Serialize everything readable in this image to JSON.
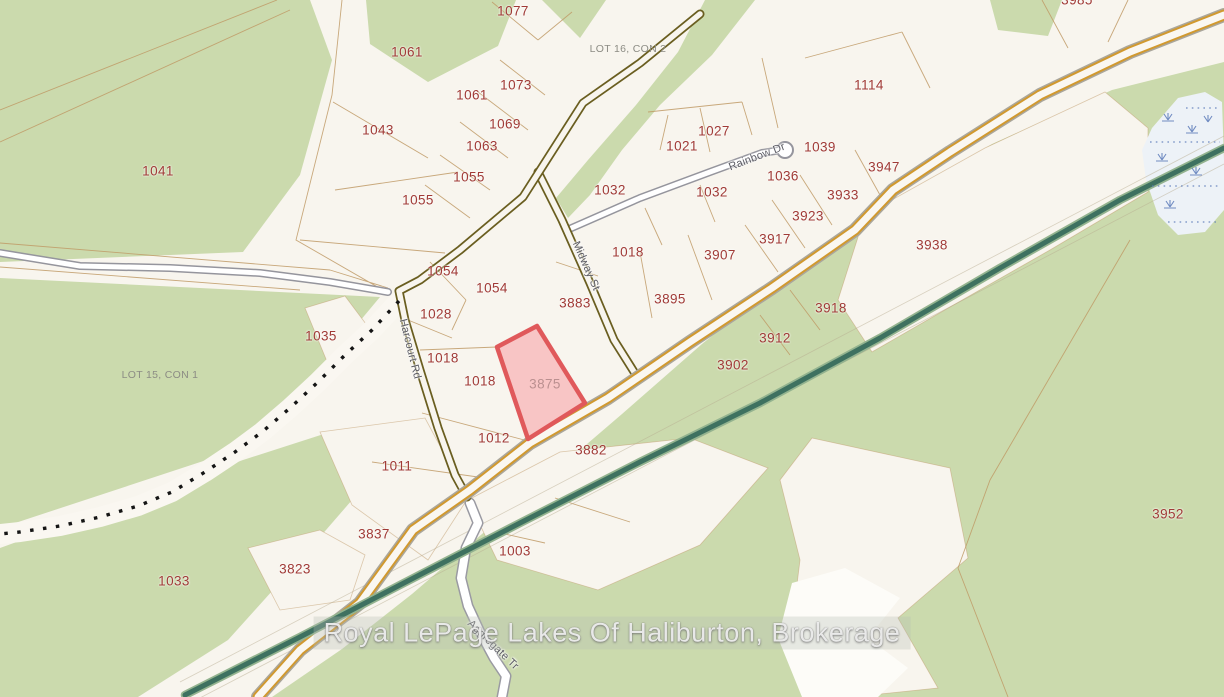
{
  "map": {
    "watermark": {
      "text": "Royal LePage Lakes Of Haliburton, Brokerage"
    },
    "highlighted_parcel": {
      "id": "3875",
      "fill": "#f8c5c5",
      "border": "#e0595b"
    },
    "colors": {
      "background_cream": "#f8f5ee",
      "vegetation_green": "#cbdaad",
      "main_road_orange": "#d1992f",
      "local_road_olive": "#6a5e20",
      "minor_road_gray": "#95959d",
      "rail_trail_green": "#3e7160",
      "parcel_line_tan": "#c09a66",
      "parcel_number_red": "#a03a36",
      "wetland_blue": "#edf2f7"
    },
    "parcel_labels": [
      {
        "text": "1077",
        "x": 513,
        "y": 11
      },
      {
        "text": "1061",
        "x": 407,
        "y": 52
      },
      {
        "text": "1061",
        "x": 472,
        "y": 95
      },
      {
        "text": "1073",
        "x": 516,
        "y": 85
      },
      {
        "text": "1069",
        "x": 505,
        "y": 124
      },
      {
        "text": "1063",
        "x": 482,
        "y": 146
      },
      {
        "text": "1043",
        "x": 378,
        "y": 130
      },
      {
        "text": "1055",
        "x": 469,
        "y": 177
      },
      {
        "text": "1055",
        "x": 418,
        "y": 200
      },
      {
        "text": "1041",
        "x": 158,
        "y": 171
      },
      {
        "text": "1114",
        "x": 869,
        "y": 85
      },
      {
        "text": "1027",
        "x": 714,
        "y": 131
      },
      {
        "text": "1021",
        "x": 682,
        "y": 146
      },
      {
        "text": "1039",
        "x": 820,
        "y": 147
      },
      {
        "text": "1036",
        "x": 783,
        "y": 176
      },
      {
        "text": "3947",
        "x": 884,
        "y": 167
      },
      {
        "text": "1032",
        "x": 610,
        "y": 190
      },
      {
        "text": "1032",
        "x": 712,
        "y": 192
      },
      {
        "text": "3933",
        "x": 843,
        "y": 195
      },
      {
        "text": "3923",
        "x": 808,
        "y": 216
      },
      {
        "text": "3917",
        "x": 775,
        "y": 239
      },
      {
        "text": "1018",
        "x": 628,
        "y": 252
      },
      {
        "text": "3907",
        "x": 720,
        "y": 255
      },
      {
        "text": "3938",
        "x": 932,
        "y": 245
      },
      {
        "text": "1054",
        "x": 443,
        "y": 271
      },
      {
        "text": "1054",
        "x": 492,
        "y": 288
      },
      {
        "text": "3883",
        "x": 575,
        "y": 303
      },
      {
        "text": "3895",
        "x": 670,
        "y": 299
      },
      {
        "text": "1028",
        "x": 436,
        "y": 314
      },
      {
        "text": "3918",
        "x": 831,
        "y": 308
      },
      {
        "text": "1035",
        "x": 321,
        "y": 336
      },
      {
        "text": "3912",
        "x": 775,
        "y": 338
      },
      {
        "text": "1018",
        "x": 443,
        "y": 358
      },
      {
        "text": "1018",
        "x": 480,
        "y": 381
      },
      {
        "text": "3875",
        "x": 545,
        "y": 384,
        "muted": true
      },
      {
        "text": "3902",
        "x": 733,
        "y": 365
      },
      {
        "text": "1012",
        "x": 494,
        "y": 438
      },
      {
        "text": "3882",
        "x": 591,
        "y": 450
      },
      {
        "text": "1011",
        "x": 397,
        "y": 466
      },
      {
        "text": "3837",
        "x": 374,
        "y": 534
      },
      {
        "text": "1003",
        "x": 515,
        "y": 551
      },
      {
        "text": "3823",
        "x": 295,
        "y": 569
      },
      {
        "text": "1033",
        "x": 174,
        "y": 581
      },
      {
        "text": "3952",
        "x": 1168,
        "y": 514
      },
      {
        "text": "3985",
        "x": 1077,
        "y": 0
      }
    ],
    "road_labels": [
      {
        "text": "Harcourt Rd",
        "x": 410,
        "y": 349,
        "angle": 76
      },
      {
        "text": "Midway St",
        "x": 586,
        "y": 266,
        "angle": 66
      },
      {
        "text": "Rainbow Dr",
        "x": 757,
        "y": 157,
        "angle": -21
      },
      {
        "text": "Aggregate Tr",
        "x": 493,
        "y": 645,
        "angle": 44
      }
    ],
    "lot_labels": [
      {
        "text": "LOT 16, CON 2",
        "x": 628,
        "y": 49
      },
      {
        "text": "LOT 15, CON 1",
        "x": 160,
        "y": 375
      }
    ]
  }
}
